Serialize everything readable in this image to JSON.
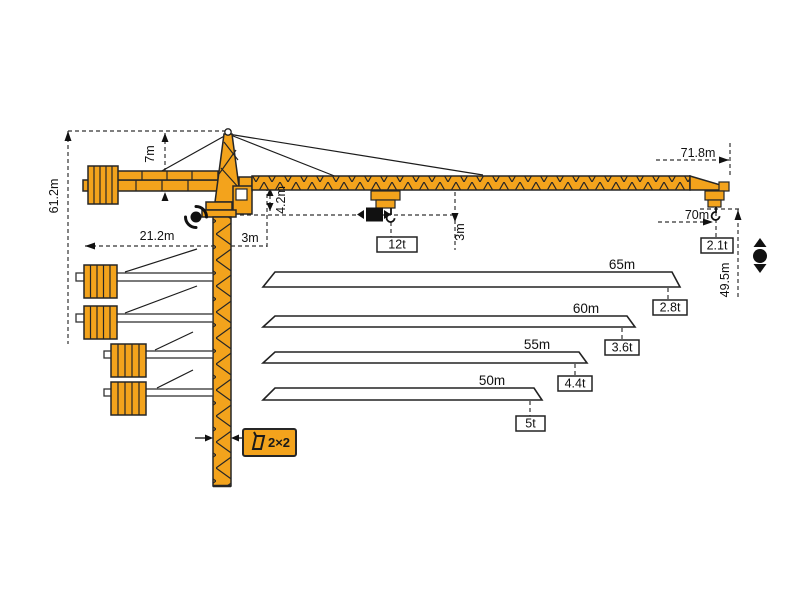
{
  "title": "tower-crane-dimensions-diagram",
  "colors": {
    "crane_orange": "#F3A31C",
    "outline": "#262626",
    "dim_line": "#333333"
  },
  "dimensions": {
    "total_height": "61.2m",
    "head_height": "7m",
    "counter_jib_radius": "21.2m",
    "rear_offset": "3m",
    "under_jib_clearance": "4.2m",
    "trolley_hook_offset": "3m",
    "max_radius": "71.8m",
    "max_hook_radius": "70m",
    "hook_height": "49.5m",
    "mast_section": "2×2"
  },
  "capacities": {
    "max_load": "12t",
    "tip_load": "2.1t"
  },
  "jib_options": [
    {
      "length": "65m",
      "tip_capacity": "2.8t"
    },
    {
      "length": "60m",
      "tip_capacity": "3.6t"
    },
    {
      "length": "55m",
      "tip_capacity": "4.4t"
    },
    {
      "length": "50m",
      "tip_capacity": "5t"
    }
  ],
  "icons": {
    "slewing": "slewing-rotation",
    "trolley": "trolley-travel",
    "hoist": "hoist-up-down"
  }
}
